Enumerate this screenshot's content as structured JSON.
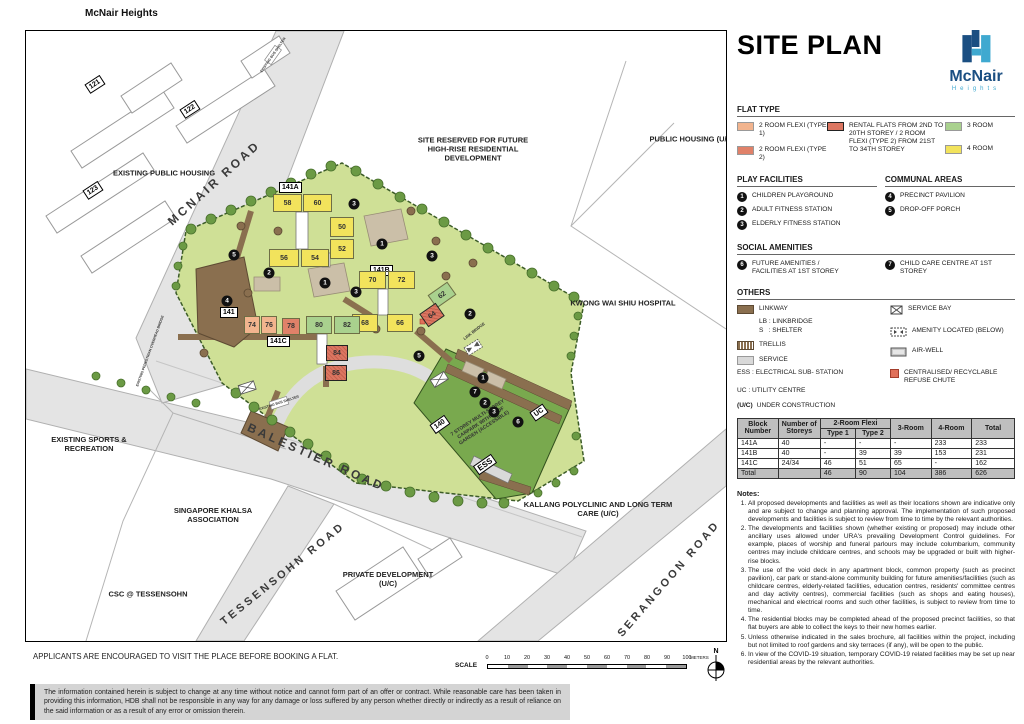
{
  "colors": {
    "four_room": "#F2E35C",
    "three_room": "#A9D18E",
    "two_room_type1": "#F2B48E",
    "two_room_type2": "#E08169",
    "rental": "#DC7661",
    "linkway": "#8A6F4F",
    "service": "#D9D9D9",
    "lawn": "#CFE096",
    "carpark_roof": "#79A94E",
    "road": "#E4E4E4",
    "logo_dark": "#1B4F82",
    "logo_light": "#3FA9D0"
  },
  "map": {
    "title": "McNair Heights",
    "areas": {
      "existing_public_housing": "EXISTING PUBLIC HOUSING",
      "site_reserved": "SITE RESERVED FOR FUTURE HIGH-RISE RESIDENTIAL DEVELOPMENT",
      "public_housing_uc": "PUBLIC HOUSING (U/C)",
      "kwong_wai_shiu": "KWONG WAI SHIU HOSPITAL",
      "existing_sports": "EXISTING SPORTS & RECREATION",
      "khalsa": "SINGAPORE KHALSA ASSOCIATION",
      "csc": "CSC @ TESSENSOHN",
      "private_dev": "PRIVATE DEVELOPMENT (U/C)",
      "kallang": "KALLANG POLYCLINIC AND LONG TERM CARE (U/C)"
    },
    "roads": {
      "mcnair": "MCNAIR ROAD",
      "balestier": "BALESTIER ROAD",
      "tessensohn": "TESSENSOHN ROAD",
      "serangoon": "SERANGOON ROAD"
    },
    "badges": {
      "a": "141A",
      "b": "141B",
      "c": "141C",
      "existing": "141",
      "mscp": "140",
      "uc": "UC",
      "ess": "ESS",
      "e121": "121",
      "e122": "122",
      "e123": "123"
    },
    "units": {
      "u58": "58",
      "u60": "60",
      "u50": "50",
      "u52": "52",
      "u56": "56",
      "u54": "54",
      "u70": "70",
      "u72": "72",
      "u68": "68",
      "u66": "66",
      "u62": "62",
      "u64": "64",
      "u74": "74",
      "u76": "76",
      "u78": "78",
      "u80": "80",
      "u82": "82",
      "u84": "84",
      "u86": "86"
    },
    "markers": [
      "1",
      "2",
      "3",
      "4",
      "5",
      "6",
      "7"
    ],
    "small": {
      "link_bridge": "LINK BRIDGE",
      "bus_shelter": "EXISTING BUS SHELTER",
      "ped_bridge": "EXISTING PEDESTRIAN OVERHEAD BRIDGE",
      "carpark_label": "7 STOREY MULTI-STOREY CARPARK WITH ROOF GARDEN (ACCESSIBLE)"
    }
  },
  "panel": {
    "title": "SITE PLAN",
    "logo": {
      "name": "McNair",
      "sub": "Heights"
    },
    "flat_type": {
      "title": "FLAT TYPE",
      "t1": "2 ROOM FLEXI (TYPE 1)",
      "t2": "2 ROOM FLEXI (TYPE 2)",
      "rental": "RENTAL FLATS FROM 2ND TO 20TH STOREY / 2 ROOM FLEXI (TYPE 2) FROM 21ST TO 34TH STOREY",
      "r3": "3 ROOM",
      "r4": "4 ROOM"
    },
    "play": {
      "title": "PLAY FACILITIES",
      "items": [
        {
          "num": "1",
          "label": "CHILDREN PLAYGROUND"
        },
        {
          "num": "2",
          "label": "ADULT FITNESS STATION"
        },
        {
          "num": "3",
          "label": "ELDERLY FITNESS STATION"
        }
      ]
    },
    "communal": {
      "title": "COMMUNAL AREAS",
      "items": [
        {
          "num": "4",
          "label": "PRECINCT PAVILION"
        },
        {
          "num": "5",
          "label": "DROP-OFF PORCH"
        }
      ]
    },
    "social": {
      "title": "SOCIAL AMENITIES",
      "items": [
        {
          "num": "6",
          "label": "FUTURE AMENITIES / FACILITIES AT 1ST STOREY"
        },
        {
          "num": "7",
          "label": "CHILD CARE CENTRE AT 1ST STOREY"
        }
      ]
    },
    "others": {
      "title": "OTHERS",
      "linkway": "LINKWAY",
      "lb": "LB : LINKBRIDGE",
      "s": "S  : SHELTER",
      "trellis": "TRELLIS",
      "service": "SERVICE",
      "ess": "ESS : ELECTRICAL SUB- STATION",
      "uc": "UC : UTILITY CENTRE",
      "uc_note_prefix": "(U/C)",
      "uc_note": "UNDER CONSTRUCTION",
      "service_bay": "SERVICE BAY",
      "amenity": "AMENITY LOCATED (BELOW)",
      "airwell": "AIR-WELL",
      "refuse": "CENTRALISED/ RECYCLABLE REFUSE CHUTE"
    }
  },
  "table": {
    "h_block": "Block Number",
    "h_storeys": "Number of Storeys",
    "h_2room": "2-Room Flexi",
    "h_t1": "Type 1",
    "h_t2": "Type 2",
    "h_3": "3-Room",
    "h_4": "4-Room",
    "h_total": "Total",
    "rows": [
      [
        "141A",
        "40",
        "-",
        "-",
        "-",
        "233",
        "233"
      ],
      [
        "141B",
        "40",
        "-",
        "39",
        "39",
        "153",
        "231"
      ],
      [
        "141C",
        "24/34",
        "46",
        "51",
        "65",
        "-",
        "162"
      ],
      [
        "Total",
        "",
        "46",
        "90",
        "104",
        "386",
        "626"
      ]
    ]
  },
  "notes": {
    "title": "Notes:",
    "items": [
      "All proposed developments and facilities as well as their locations shown are indicative only and are subject to change and planning approval. The implementation of such proposed developments and facilities is subject to review from time to time by the relevant authorities.",
      "The developments and facilities shown (whether existing or proposed) may include other ancillary uses allowed under URA's prevailing Development Control guidelines. For example, places of worship and funeral parlours may include columbarium, community centres may include childcare centres, and schools may be upgraded or built with higher-rise blocks.",
      "The use of the void deck in any apartment block, common property (such as precinct pavilion), car park or stand-alone community building for future amenities/facilities (such as childcare centres, elderly-related facilities, education centres, residents' committee centres and day activity centres), commercial facilities (such as shops and eating houses), mechanical and electrical rooms and such other facilities, is subject to review from time to time.",
      "The residential blocks may be completed ahead of the proposed precinct facilities, so that flat buyers are able to collect the keys to their new homes earlier.",
      "Unless otherwise indicated in the sales brochure, all facilities within the project, including but not limited to roof gardens and sky terraces (if any), will be open to the public.",
      "In view of the COVID-19 situation, temporary COVID-19 related facilities may be set up near residential areas by the relevant authorities."
    ]
  },
  "footer": {
    "applicants": "APPLICANTS ARE ENCOURAGED TO VISIT THE PLACE BEFORE BOOKING A FLAT.",
    "scale_label": "SCALE",
    "ticks": [
      "0",
      "10",
      "20",
      "30",
      "40",
      "50",
      "60",
      "70",
      "80",
      "90",
      "100"
    ],
    "unit": "METERS",
    "north": "N",
    "disclaimer": "The information contained herein is subject to change at any time without notice and cannot form part of an offer or contract. While reasonable care has been taken in providing this information, HDB shall not be responsible in any way for any damage or loss suffered by any person whether directly or indirectly as a result of reliance on the said information or as a result of any error or omission therein."
  }
}
